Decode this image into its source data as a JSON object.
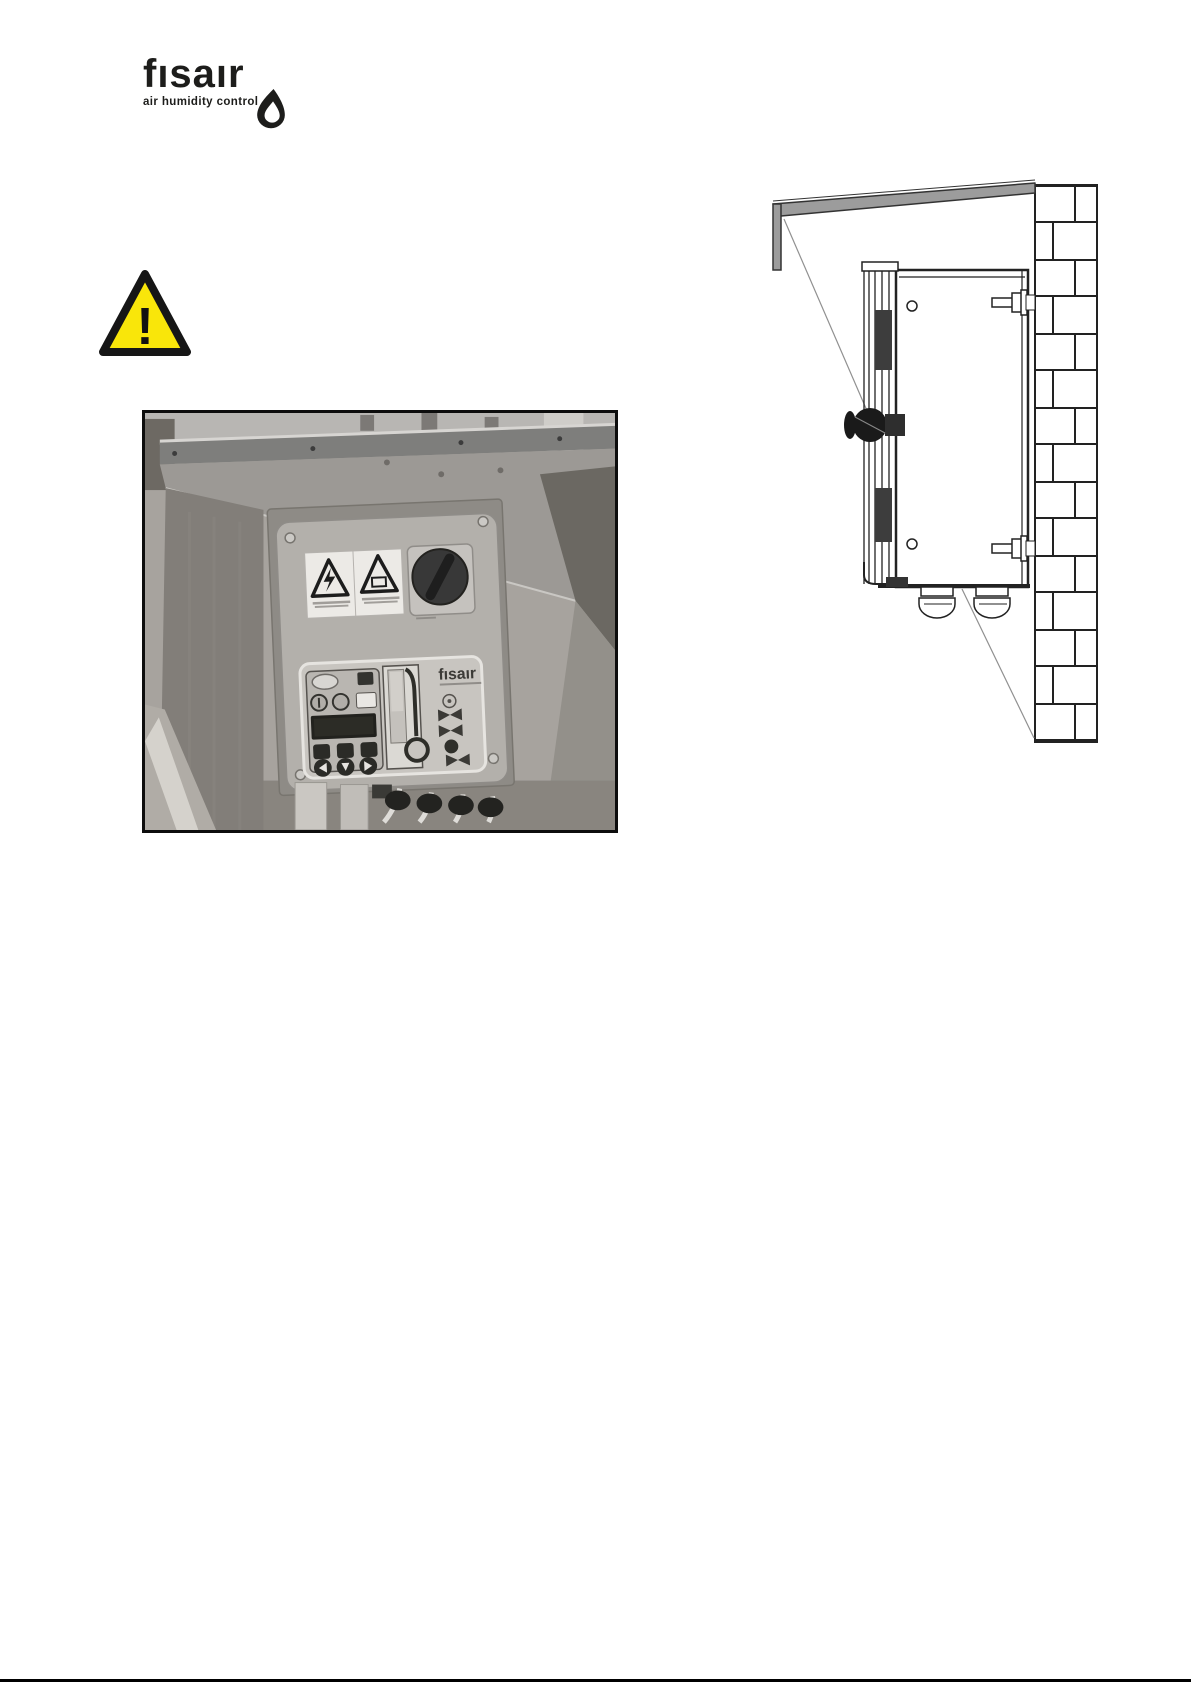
{
  "page": {
    "background": "#ffffff"
  },
  "header": {
    "logo": {
      "wordmark": "fısaır",
      "tagline": "air humidity control",
      "color": "#1d1d1b",
      "droplet_icon": "water-drop-icon"
    }
  },
  "warning_icon": {
    "mark": "!",
    "fill": "#f9e60a",
    "border": "#161616"
  },
  "photo_figure": {
    "panel_logo": "fısaır",
    "content": "grayscale photo of humidifier control cabinet with weather hood, warning stickers, rotary switch, controller panel and bottom cable glands"
  },
  "diagram_figure": {
    "content": "line drawing: side view of unit fixed to a brick wall with rain hood, two wall bolts and two cable glands",
    "hood_fill": "#9c9c9c",
    "line_color": "#222222"
  },
  "footer": {
    "rule_color": "#000000"
  }
}
